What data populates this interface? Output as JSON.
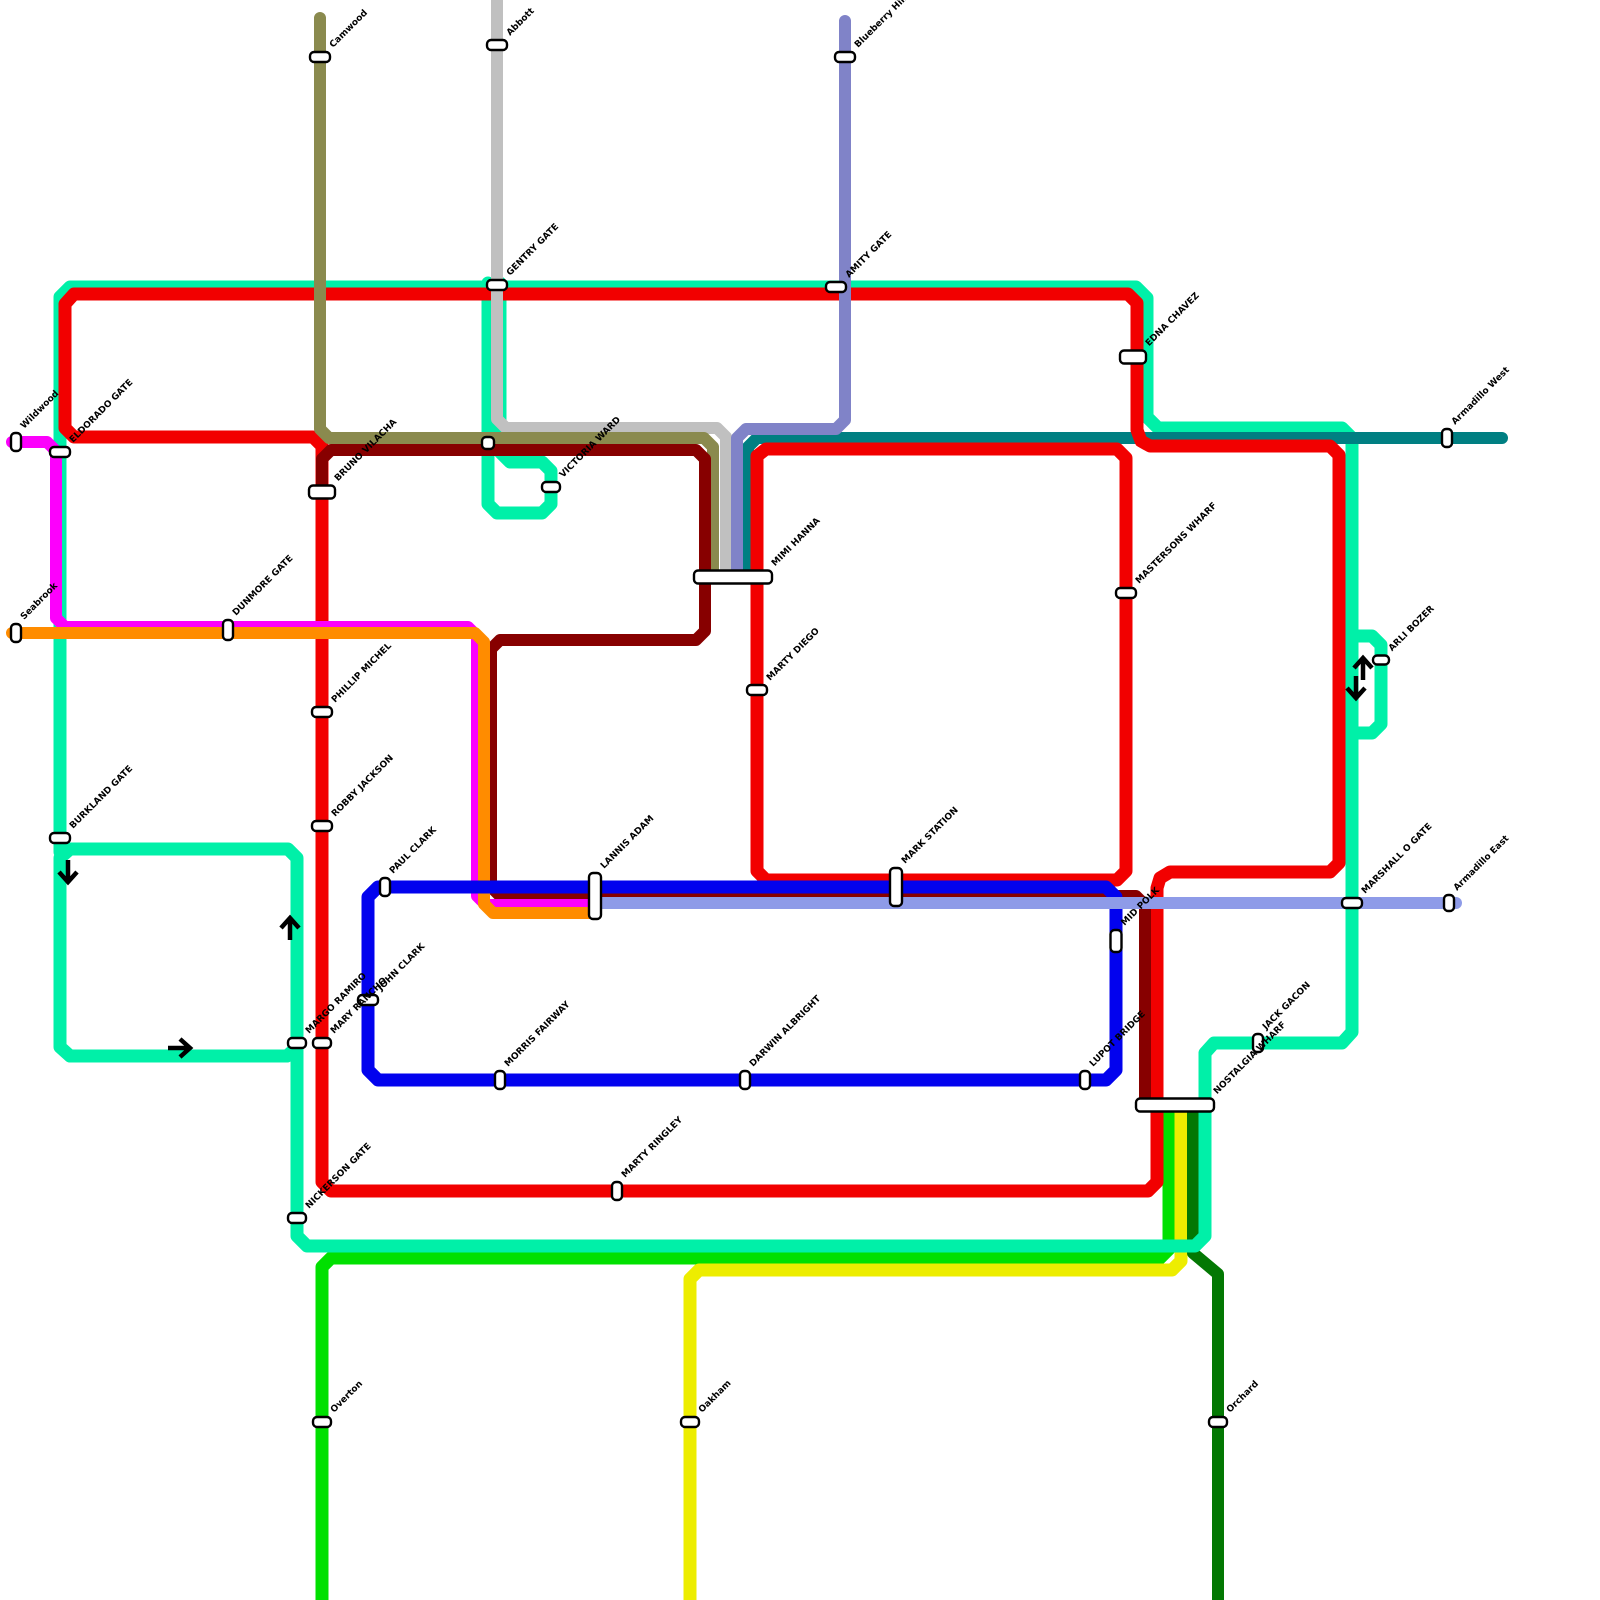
{
  "canvas": {
    "width": 1600,
    "height": 1600,
    "background": "#ffffff"
  },
  "map_title": "transit-network-map",
  "label_style": {
    "color": "#000000",
    "size": 9,
    "angle": -45
  },
  "station_style": {
    "fill": "#ffffff",
    "border": "#000000"
  },
  "lines": [
    {
      "id": "green",
      "name": "green-line",
      "color": "#00E000",
      "width": 13,
      "closed": false,
      "points": [
        [
          1169,
          1112
        ],
        [
          1169,
          1249
        ],
        [
          1160,
          1258
        ],
        [
          331,
          1258
        ],
        [
          322,
          1267
        ],
        [
          322,
          1600
        ]
      ]
    },
    {
      "id": "yellow",
      "name": "yellow-line",
      "color": "#EDED00",
      "width": 13,
      "closed": false,
      "points": [
        [
          1181,
          1112
        ],
        [
          1181,
          1261
        ],
        [
          1172,
          1270
        ],
        [
          699,
          1270
        ],
        [
          690,
          1279
        ],
        [
          690,
          1600
        ]
      ]
    },
    {
      "id": "dark-green",
      "name": "dark-green-line",
      "color": "#037803",
      "width": 12,
      "closed": false,
      "points": [
        [
          1193,
          1112
        ],
        [
          1193,
          1253
        ],
        [
          1218,
          1274
        ],
        [
          1218,
          1600
        ]
      ]
    },
    {
      "id": "turquoise-main",
      "name": "turquoise-line-main",
      "color": "#00F0A8",
      "width": 13,
      "closed": false,
      "points": [
        [
          60,
          852
        ],
        [
          60,
          297
        ],
        [
          70,
          287
        ],
        [
          1136,
          287
        ],
        [
          1147,
          298
        ],
        [
          1147,
          417
        ],
        [
          1158,
          428
        ],
        [
          1342,
          428
        ],
        [
          1352,
          438
        ],
        [
          1352,
          1032
        ],
        [
          1342,
          1043
        ],
        [
          1214,
          1043
        ],
        [
          1205,
          1053
        ],
        [
          1205,
          1236
        ],
        [
          1195,
          1246
        ],
        [
          307,
          1246
        ],
        [
          297,
          1236
        ],
        [
          297,
          858
        ],
        [
          288,
          849
        ],
        [
          70,
          849
        ],
        [
          60,
          858
        ],
        [
          60,
          1047
        ],
        [
          70,
          1056
        ],
        [
          287,
          1056
        ],
        [
          297,
          1047
        ]
      ]
    },
    {
      "id": "turquoise-bulge",
      "name": "turquoise-detour-loop",
      "color": "#00F0A8",
      "width": 13,
      "closed": false,
      "points": [
        [
          1352,
          636
        ],
        [
          1372,
          636
        ],
        [
          1381,
          645
        ],
        [
          1381,
          724
        ],
        [
          1372,
          733
        ],
        [
          1352,
          733
        ]
      ]
    },
    {
      "id": "turquoise-pendant",
      "name": "turquoise-branch-loop",
      "color": "#00F0A8",
      "width": 13,
      "closed": false,
      "points": [
        [
          488,
          283
        ],
        [
          488,
          504
        ],
        [
          497,
          513
        ],
        [
          542,
          513
        ],
        [
          551,
          504
        ],
        [
          551,
          471
        ],
        [
          542,
          462
        ],
        [
          510,
          462
        ],
        [
          500,
          452
        ],
        [
          500,
          283
        ]
      ]
    },
    {
      "id": "teal",
      "name": "teal-line",
      "color": "#007F82",
      "width": 12,
      "closed": false,
      "points": [
        [
          1502,
          438
        ],
        [
          757,
          438
        ],
        [
          748,
          447
        ],
        [
          748,
          576
        ]
      ]
    },
    {
      "id": "red-outer",
      "name": "red-line-outer-loop",
      "color": "#F20000",
      "width": 13,
      "closed": true,
      "points": [
        [
          65,
          428
        ],
        [
          65,
          304
        ],
        [
          74,
          294
        ],
        [
          1128,
          294
        ],
        [
          1137,
          303
        ],
        [
          1137,
          430
        ],
        [
          1141,
          441
        ],
        [
          1150,
          446
        ],
        [
          1330,
          446
        ],
        [
          1339,
          455
        ],
        [
          1339,
          863
        ],
        [
          1330,
          872
        ],
        [
          1170,
          872
        ],
        [
          1160,
          878
        ],
        [
          1157,
          888
        ],
        [
          1157,
          1182
        ],
        [
          1148,
          1191
        ],
        [
          331,
          1191
        ],
        [
          322,
          1182
        ],
        [
          322,
          446
        ],
        [
          313,
          437
        ],
        [
          74,
          437
        ]
      ]
    },
    {
      "id": "red-inner",
      "name": "red-line-inner-loop",
      "color": "#F20000",
      "width": 13,
      "closed": true,
      "points": [
        [
          757,
          456
        ],
        [
          757,
          871
        ],
        [
          766,
          880
        ],
        [
          1117,
          880
        ],
        [
          1126,
          871
        ],
        [
          1126,
          458
        ],
        [
          1117,
          449
        ],
        [
          766,
          449
        ]
      ]
    },
    {
      "id": "gray",
      "name": "gray-line",
      "color": "#C0C0C0",
      "width": 12,
      "closed": false,
      "points": [
        [
          497,
          0
        ],
        [
          497,
          419
        ],
        [
          506,
          428
        ],
        [
          717,
          428
        ],
        [
          726,
          437
        ],
        [
          726,
          576
        ]
      ]
    },
    {
      "id": "olive",
      "name": "olive-line",
      "color": "#8A8A4E",
      "width": 12,
      "closed": false,
      "points": [
        [
          320,
          18
        ],
        [
          320,
          429
        ],
        [
          329,
          438
        ],
        [
          704,
          438
        ],
        [
          713,
          447
        ],
        [
          713,
          576
        ]
      ]
    },
    {
      "id": "slate-top",
      "name": "slate-blue-line",
      "color": "#8083C8",
      "width": 12,
      "closed": false,
      "points": [
        [
          845,
          21
        ],
        [
          845,
          420
        ],
        [
          836,
          429
        ],
        [
          746,
          429
        ],
        [
          737,
          438
        ],
        [
          737,
          576
        ]
      ]
    },
    {
      "id": "maroon",
      "name": "maroon-line",
      "color": "#870000",
      "width": 12,
      "closed": false,
      "points": [
        [
          322,
          492
        ],
        [
          322,
          459
        ],
        [
          331,
          450
        ],
        [
          696,
          450
        ],
        [
          705,
          459
        ],
        [
          705,
          631
        ],
        [
          696,
          640
        ],
        [
          500,
          640
        ],
        [
          491,
          649
        ],
        [
          491,
          887
        ],
        [
          500,
          896
        ],
        [
          1136,
          896
        ],
        [
          1145,
          905
        ],
        [
          1145,
          1100
        ]
      ]
    },
    {
      "id": "magenta",
      "name": "magenta-line",
      "color": "#FC00FC",
      "width": 12,
      "closed": false,
      "points": [
        [
          12,
          442
        ],
        [
          47,
          442
        ],
        [
          56,
          451
        ],
        [
          56,
          618
        ],
        [
          65,
          627
        ],
        [
          468,
          627
        ],
        [
          477,
          636
        ],
        [
          477,
          896
        ],
        [
          486,
          905
        ],
        [
          590,
          905
        ]
      ]
    },
    {
      "id": "orange",
      "name": "orange-line",
      "color": "#FF8C00",
      "width": 12,
      "closed": false,
      "points": [
        [
          12,
          633
        ],
        [
          466,
          633
        ],
        [
          475,
          633
        ],
        [
          484,
          642
        ],
        [
          484,
          904
        ],
        [
          493,
          913
        ],
        [
          590,
          913
        ]
      ]
    },
    {
      "id": "blue-loop",
      "name": "blue-line-loop",
      "color": "#0202EE",
      "width": 13,
      "closed": true,
      "points": [
        [
          368,
          897
        ],
        [
          368,
          1070
        ],
        [
          378,
          1080
        ],
        [
          1106,
          1080
        ],
        [
          1116,
          1070
        ],
        [
          1116,
          897
        ],
        [
          1106,
          887
        ],
        [
          378,
          887
        ]
      ]
    },
    {
      "id": "slate-east",
      "name": "periwinkle-line",
      "color": "#8E9BE8",
      "width": 12,
      "closed": false,
      "points": [
        [
          600,
          903
        ],
        [
          1456,
          903
        ]
      ]
    }
  ],
  "stations": [
    {
      "id": "camwood",
      "label": "Camwood",
      "x": 320,
      "y": 57,
      "w": 20,
      "h": 10
    },
    {
      "id": "abbott",
      "label": "Abbott",
      "x": 497,
      "y": 45,
      "w": 20,
      "h": 10
    },
    {
      "id": "blueberry-hill",
      "label": "Blueberry Hill",
      "x": 845,
      "y": 57,
      "w": 20,
      "h": 10
    },
    {
      "id": "gentry-gate",
      "label": "GENTRY GATE",
      "x": 497,
      "y": 285,
      "w": 20,
      "h": 10
    },
    {
      "id": "amity-gate",
      "label": "AMITY GATE",
      "x": 836,
      "y": 287,
      "w": 20,
      "h": 10
    },
    {
      "id": "edna-chavez",
      "label": "EDNA CHAVEZ",
      "x": 1133,
      "y": 357,
      "w": 26,
      "h": 13
    },
    {
      "id": "armadillo-west",
      "label": "Armadillo West",
      "x": 1447,
      "y": 438,
      "w": 10,
      "h": 18
    },
    {
      "id": "wildwood",
      "label": "Wildwood",
      "x": 16,
      "y": 442,
      "w": 10,
      "h": 18
    },
    {
      "id": "eldorado-gate",
      "label": "ELDORADO GATE",
      "x": 60,
      "y": 452,
      "w": 20,
      "h": 10
    },
    {
      "id": "bruno-vilacha",
      "label": "BRUNO VILACHA",
      "x": 322,
      "y": 492,
      "w": 26,
      "h": 13
    },
    {
      "id": "victoria-ward",
      "label": "VICTORIA WARD",
      "x": 551,
      "y": 487,
      "w": 18,
      "h": 10
    },
    {
      "id": "pendant-crossing",
      "label": "",
      "x": 488,
      "y": 443,
      "w": 12,
      "h": 12
    },
    {
      "id": "mimi-hanna",
      "label": "MIMI HANNA",
      "x": 733,
      "y": 577,
      "w": 78,
      "h": 13
    },
    {
      "id": "mastersons-wharf",
      "label": "MASTERSONS WHARF",
      "x": 1126,
      "y": 593,
      "w": 20,
      "h": 10
    },
    {
      "id": "arli-bozer",
      "label": "ARLI BOZER",
      "x": 1381,
      "y": 660,
      "w": 16,
      "h": 9
    },
    {
      "id": "seabrook",
      "label": "Seabrook",
      "x": 16,
      "y": 633,
      "w": 10,
      "h": 18
    },
    {
      "id": "dunmore-gate",
      "label": "DUNMORE GATE",
      "x": 228,
      "y": 630,
      "w": 10,
      "h": 20
    },
    {
      "id": "marty-diego",
      "label": "MARTY DIEGO",
      "x": 757,
      "y": 690,
      "w": 20,
      "h": 10
    },
    {
      "id": "phillip-michel",
      "label": "PHILLIP MICHEL",
      "x": 322,
      "y": 712,
      "w": 20,
      "h": 10
    },
    {
      "id": "burkland-gate",
      "label": "BURKLAND GATE",
      "x": 60,
      "y": 838,
      "w": 20,
      "h": 10
    },
    {
      "id": "robby-jackson",
      "label": "ROBBY JACKSON",
      "x": 322,
      "y": 826,
      "w": 20,
      "h": 10
    },
    {
      "id": "paul-clark",
      "label": "PAUL CLARK",
      "x": 385,
      "y": 887,
      "w": 10,
      "h": 18
    },
    {
      "id": "lannis-adam",
      "label": "LANNIS ADAM",
      "x": 595,
      "y": 896,
      "w": 12,
      "h": 46
    },
    {
      "id": "mark-station",
      "label": "MARK STATION",
      "x": 896,
      "y": 887,
      "w": 12,
      "h": 38
    },
    {
      "id": "mid-polk",
      "label": "MID POLK",
      "x": 1116,
      "y": 941,
      "w": 11,
      "h": 22
    },
    {
      "id": "marshall-o-gate",
      "label": "MARSHALL O GATE",
      "x": 1352,
      "y": 903,
      "w": 20,
      "h": 10
    },
    {
      "id": "armadillo-east",
      "label": "Armadillo East",
      "x": 1449,
      "y": 903,
      "w": 10,
      "h": 16
    },
    {
      "id": "john-clark",
      "label": "JOHN CLARK",
      "x": 368,
      "y": 1000,
      "w": 20,
      "h": 10
    },
    {
      "id": "margo-ramiro",
      "label": "MARGO RAMIRO",
      "x": 297,
      "y": 1043,
      "w": 18,
      "h": 10
    },
    {
      "id": "mary-rancho",
      "label": "MARY RANCHO",
      "x": 322,
      "y": 1043,
      "w": 18,
      "h": 10
    },
    {
      "id": "morris-fairway",
      "label": "MORRIS FAIRWAY",
      "x": 500,
      "y": 1080,
      "w": 10,
      "h": 18
    },
    {
      "id": "darwin-albright",
      "label": "DARWIN ALBRIGHT",
      "x": 745,
      "y": 1080,
      "w": 10,
      "h": 18
    },
    {
      "id": "lupot-bridge",
      "label": "LUPOT BRIDGE",
      "x": 1085,
      "y": 1080,
      "w": 10,
      "h": 18
    },
    {
      "id": "jack-gacon",
      "label": "JACK GACON",
      "x": 1258,
      "y": 1043,
      "w": 10,
      "h": 18
    },
    {
      "id": "nostalgia-wharf",
      "label": "NOSTALGIA WHARF",
      "x": 1175,
      "y": 1105,
      "w": 78,
      "h": 13
    },
    {
      "id": "marty-ringley",
      "label": "MARTY RINGLEY",
      "x": 617,
      "y": 1191,
      "w": 10,
      "h": 18
    },
    {
      "id": "nickerson-gate",
      "label": "NICKERSON GATE",
      "x": 297,
      "y": 1218,
      "w": 18,
      "h": 10
    },
    {
      "id": "overton",
      "label": "Overton",
      "x": 322,
      "y": 1422,
      "w": 18,
      "h": 10
    },
    {
      "id": "oakham",
      "label": "Oakham",
      "x": 690,
      "y": 1422,
      "w": 18,
      "h": 10
    },
    {
      "id": "orchard",
      "label": "Orchard",
      "x": 1218,
      "y": 1422,
      "w": 18,
      "h": 10
    }
  ],
  "arrows": [
    {
      "id": "arrow-left-loop-down",
      "x": 68,
      "y": 884,
      "angle": 180
    },
    {
      "id": "arrow-left-loop-up",
      "x": 290,
      "y": 916,
      "angle": 0
    },
    {
      "id": "arrow-left-loop-right",
      "x": 192,
      "y": 1048,
      "angle": 90
    },
    {
      "id": "arrow-detour-up",
      "x": 1363,
      "y": 656,
      "angle": 0
    },
    {
      "id": "arrow-detour-down",
      "x": 1356,
      "y": 700,
      "angle": 180
    }
  ]
}
